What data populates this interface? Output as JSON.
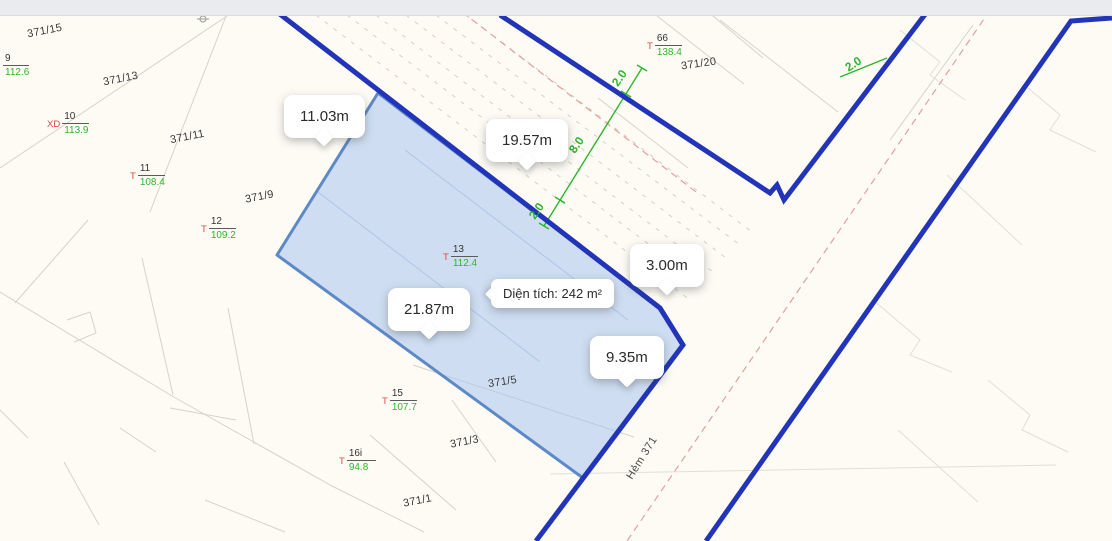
{
  "measurement_tooltips": [
    {
      "label": "11.03m"
    },
    {
      "label": "19.57m"
    },
    {
      "label": "3.00m"
    },
    {
      "label": "21.87m"
    },
    {
      "label": "9.35m"
    }
  ],
  "area_tooltip": {
    "label": "Diện tích: 242 m²"
  },
  "parcel_numbers": [
    {
      "label": "371/15"
    },
    {
      "label": "371/13"
    },
    {
      "label": "371/11"
    },
    {
      "label": "371/9"
    },
    {
      "label": "371/20"
    },
    {
      "label": "371/5"
    },
    {
      "label": "371/3"
    },
    {
      "label": "371/1"
    }
  ],
  "lot_marks": [
    {
      "prefix": "",
      "num": "9",
      "area": "112.6"
    },
    {
      "prefix": "XD",
      "num": "10",
      "area": "113.9"
    },
    {
      "prefix": "T",
      "num": "11",
      "area": "108.4"
    },
    {
      "prefix": "T",
      "num": "12",
      "area": "109.2"
    },
    {
      "prefix": "T",
      "num": "13",
      "area": "112.4"
    },
    {
      "prefix": "T",
      "num": "15",
      "area": "107.7"
    },
    {
      "prefix": "T",
      "num": "16i",
      "area": "94.8"
    },
    {
      "prefix": "T",
      "num": "66",
      "area": "138.4"
    }
  ],
  "dimension_labels": [
    {
      "value": "2.0"
    },
    {
      "value": "8.0"
    },
    {
      "value": "2.0"
    },
    {
      "value": "2.0"
    }
  ],
  "street": {
    "name": "Hẻm 371"
  },
  "colors": {
    "road_blue": "#2235b8",
    "parcel_fill": "#a8c5ee",
    "parcel_stroke": "#5e89c7",
    "dimension_green": "#2eb52d",
    "mark_red": "#e04545",
    "centerline_pink": "#e2a0a0",
    "faint_line_gray": "#d6d3c9"
  }
}
